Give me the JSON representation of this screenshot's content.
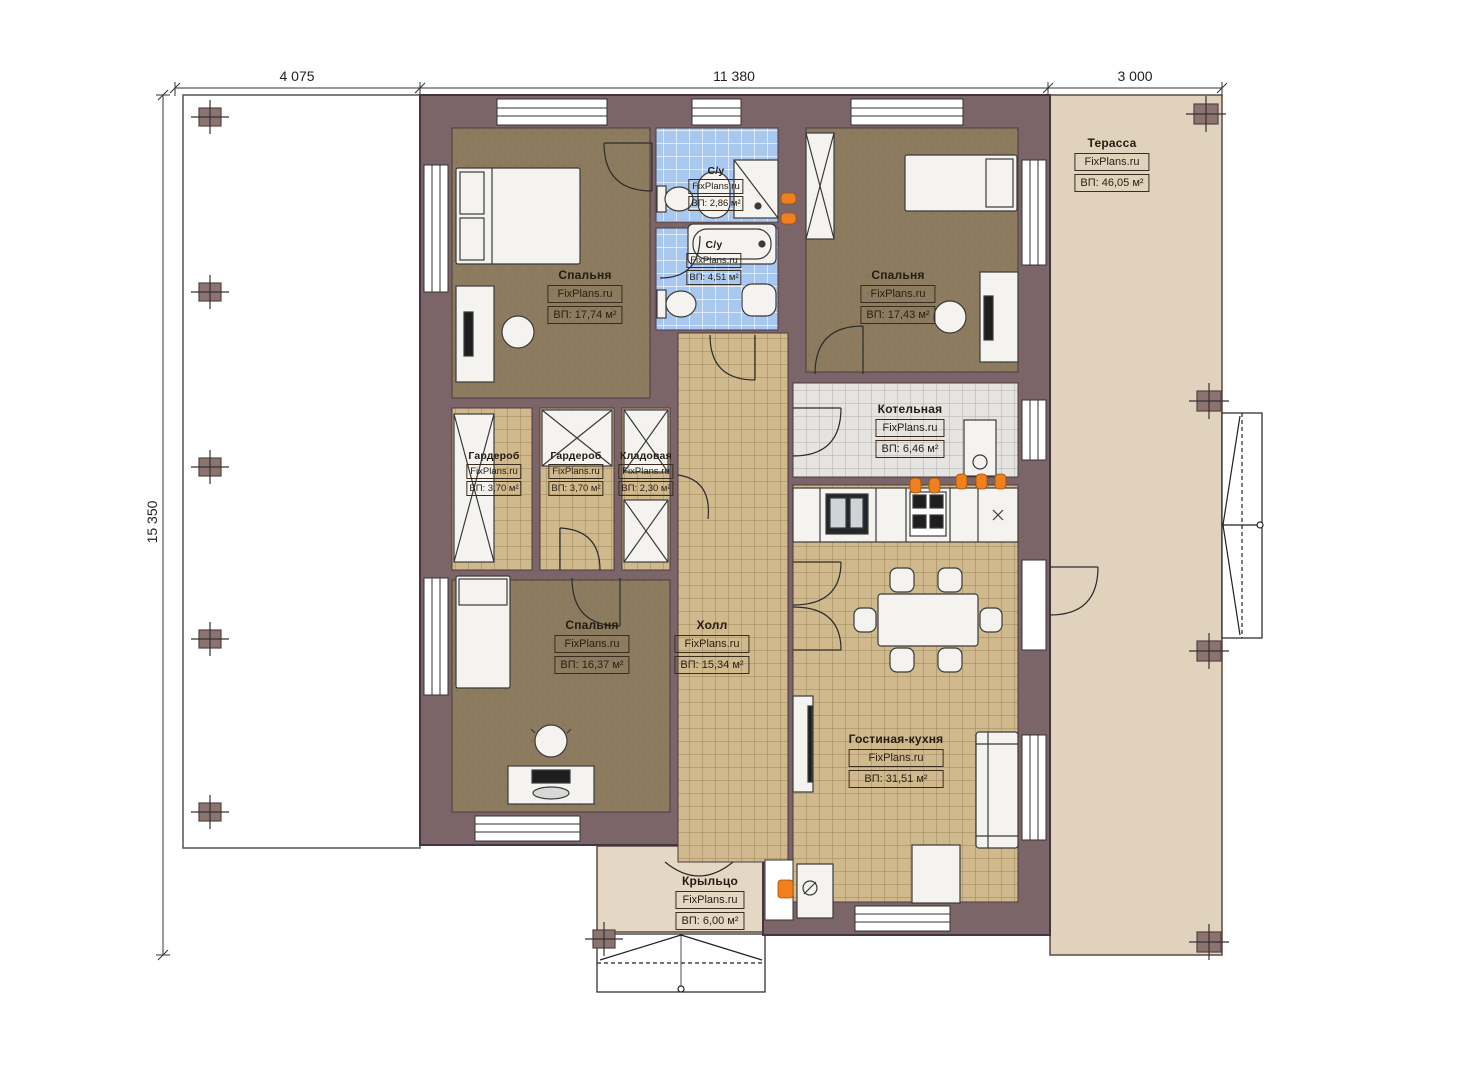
{
  "brand_watermark": "FixPlans.ru",
  "dimensions": {
    "top": [
      "4 075",
      "11 380",
      "3 000"
    ],
    "left": "15 350"
  },
  "rooms": [
    {
      "id": "bedroom-top-left",
      "name": "Спальня",
      "brand": "FixPlans.ru",
      "area": "ВП: 17,74 м²"
    },
    {
      "id": "bathroom-small",
      "name": "С/у",
      "brand": "FixPlans.ru",
      "area": "ВП: 2,86 м²"
    },
    {
      "id": "bathroom-big",
      "name": "С/у",
      "brand": "FixPlans.ru",
      "area": "ВП: 4,51 м²"
    },
    {
      "id": "bedroom-top-right",
      "name": "Спальня",
      "brand": "FixPlans.ru",
      "area": "ВП: 17,43 м²"
    },
    {
      "id": "terrace",
      "name": "Терасса",
      "brand": "FixPlans.ru",
      "area": "ВП: 46,05 м²"
    },
    {
      "id": "boiler-room",
      "name": "Котельная",
      "brand": "FixPlans.ru",
      "area": "ВП: 6,46 м²"
    },
    {
      "id": "wardrobe-1",
      "name": "Гардероб",
      "brand": "FixPlans.ru",
      "area": "ВП: 3,70 м²"
    },
    {
      "id": "wardrobe-2",
      "name": "Гардероб",
      "brand": "FixPlans.ru",
      "area": "ВП: 3,70 м²"
    },
    {
      "id": "storage",
      "name": "Кладовая",
      "brand": "FixPlans.ru",
      "area": "ВП: 2,30 м²"
    },
    {
      "id": "bedroom-bottom-left",
      "name": "Спальня",
      "brand": "FixPlans.ru",
      "area": "ВП: 16,37 м²"
    },
    {
      "id": "hall",
      "name": "Холл",
      "brand": "FixPlans.ru",
      "area": "ВП: 15,34 м²"
    },
    {
      "id": "living-kitchen",
      "name": "Гостиная-кухня",
      "brand": "FixPlans.ru",
      "area": "ВП: 31,51 м²"
    },
    {
      "id": "porch",
      "name": "Крыльцо",
      "brand": "FixPlans.ru",
      "area": "ВП: 6,00 м²"
    }
  ],
  "colors": {
    "wall": "#7b6569",
    "wall_outline": "#463540",
    "bedroom_floor": "#8c7b5e",
    "tile_tan": "#cfb98d",
    "tile_blue": "#a9c8ef",
    "tile_gray": "#e6e4e1",
    "terrace": "#e0d2bd",
    "porch": "#e4d7c3",
    "outlet_accent": "#f0801e"
  }
}
